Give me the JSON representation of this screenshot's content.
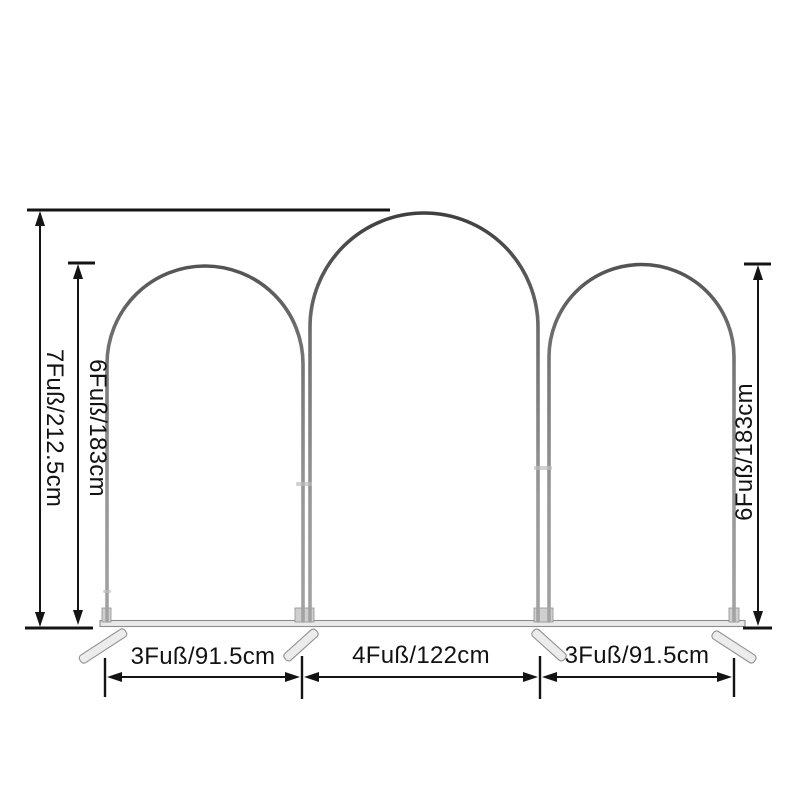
{
  "labels": {
    "overall_height": "7Fuß/212.5cm",
    "left_arch_height": "6Fuß/183cm",
    "right_arch_height": "6Fuß/183cm",
    "left_arch_width": "3Fuß/91.5cm",
    "middle_arch_width": "4Fuß/122cm",
    "right_arch_width": "3Fuß/91.5cm"
  },
  "colors": {
    "background": "#ffffff",
    "dimension_lines": "#141414",
    "frame_tube_dark": "#3c3c3c",
    "frame_tube_light": "#a6a6a6",
    "base_fill": "#e9e9e9"
  }
}
